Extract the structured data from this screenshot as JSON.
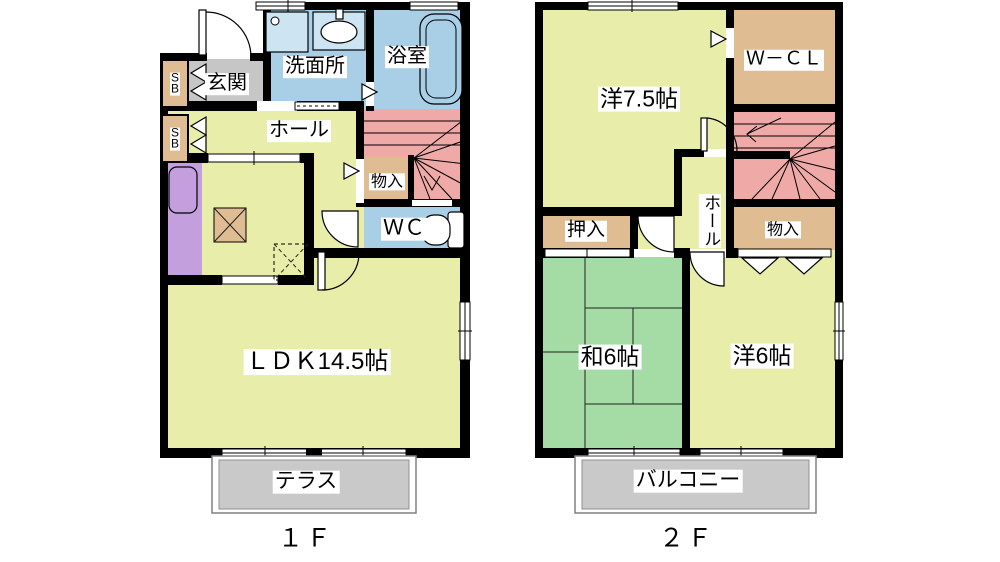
{
  "page": {
    "background": "#ffffff"
  },
  "colors": {
    "wall": "#000000",
    "room_yellow": "#e9edaa",
    "water_blue": "#a9cfe7",
    "closet_tan": "#dfbc92",
    "stair_pink": "#efaaa8",
    "tatami_green": "#a5dba5",
    "kitchen_purple": "#c3a0dd",
    "entrance_gray": "#c6c6c6",
    "terrace_gray": "#c9c9c9",
    "fixture_blue": "#cde4f2"
  },
  "floor1": {
    "label": "１Ｆ",
    "rooms": {
      "genkan": "玄関",
      "shoe_box_1": "S\nB",
      "shoe_box_2": "S\nB",
      "senmenjo": "洗面所",
      "yokushitsu": "浴室",
      "hall": "ホール",
      "mononyu": "物入",
      "wc": "ＷＣ",
      "ldk": "ＬＤＫ14.5帖",
      "terrace": "テラス"
    }
  },
  "floor2": {
    "label": "２Ｆ",
    "rooms": {
      "yoshitsu_75": "洋7.5帖",
      "wcl": "Ｗ－ＣＬ",
      "hall": "ホール",
      "oshiire": "押入",
      "mononyu": "物入",
      "washitsu_6": "和6帖",
      "yoshitsu_6": "洋6帖",
      "balcony": "バルコニー"
    }
  }
}
